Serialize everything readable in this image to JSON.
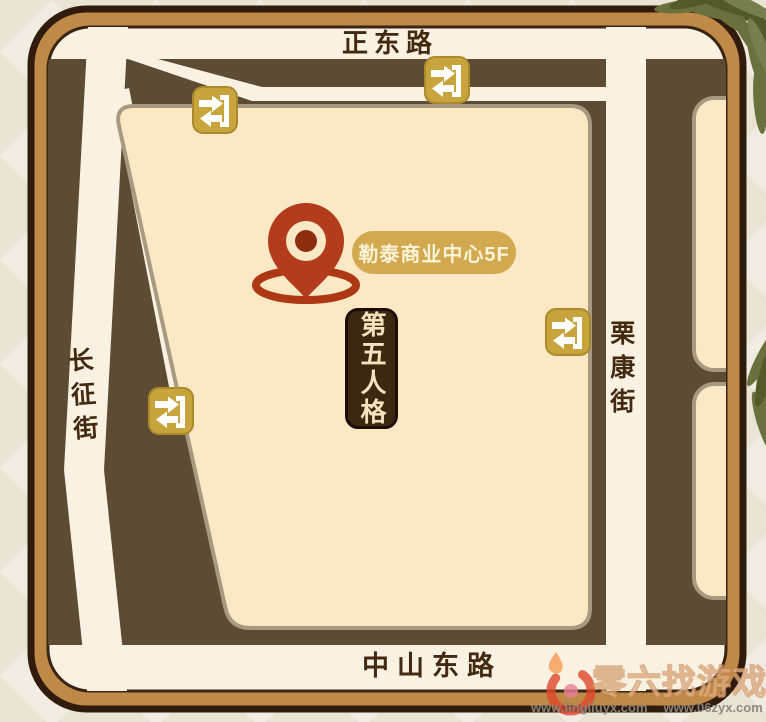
{
  "map": {
    "streets": {
      "north": "正东路",
      "south": "中山东路",
      "west": "长征街",
      "east": "栗康街"
    },
    "destination": {
      "label": "勒泰商业中心5F"
    },
    "venue_banner": {
      "label": "第五人格"
    },
    "markers": {
      "location_pin": "location-pin",
      "metro_entrance_icon": "metro-entrance-icon",
      "metro_entrance_count": 4
    }
  },
  "watermark": {
    "site_name": "零六找游戏",
    "url_left": "www.lingliuyx.com",
    "url_right": "www.06zyx.com"
  },
  "colors": {
    "frame": "#bf8a48",
    "frame_outline": "#301b0c",
    "block_dark": "#5e4b33",
    "road_cream": "#f9f2e2",
    "parcel_peach": "#fce8c4",
    "metro_icon_gold": "#c8a43c",
    "pin_rust": "#b23c1b",
    "pill_gold": "#d2a94e",
    "banner_brown": "#3f2610",
    "leaf_green": "#6a713d"
  }
}
